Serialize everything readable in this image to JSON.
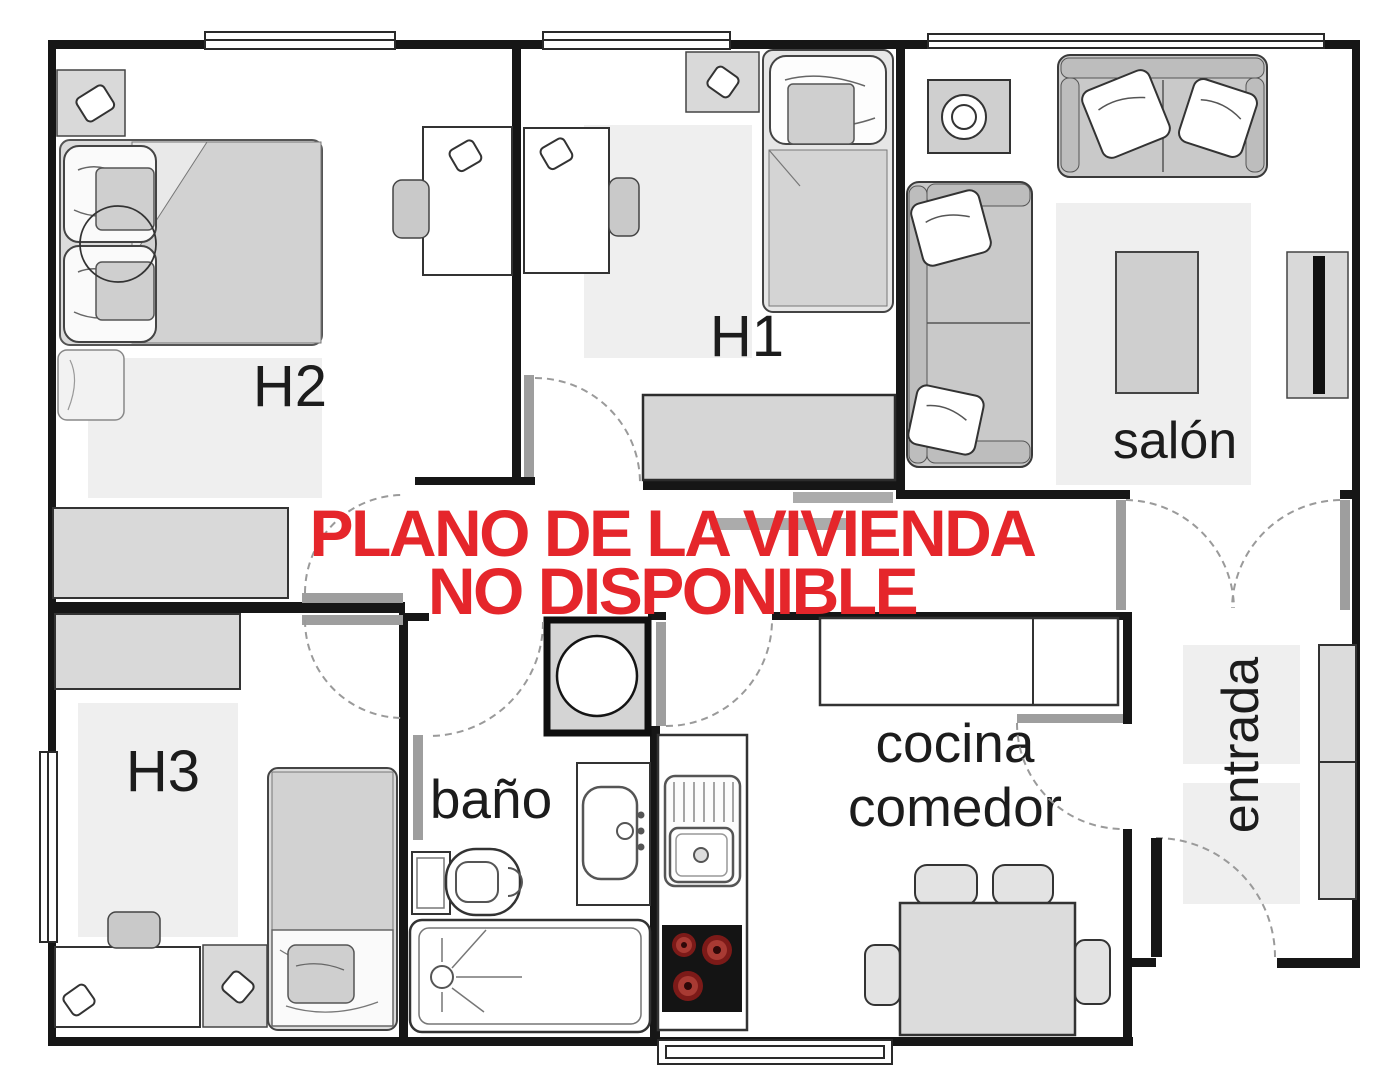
{
  "overlay": {
    "line1": "PLANO DE LA VIVIENDA",
    "line2": "NO DISPONIBLE",
    "color": "#e5262b"
  },
  "rooms": {
    "h2": {
      "label": "H2"
    },
    "h1": {
      "label": "H1"
    },
    "h3": {
      "label": "H3"
    },
    "salon": {
      "label": "salón"
    },
    "bano": {
      "label": "baño"
    },
    "cocina_comedor": {
      "line1": "cocina",
      "line2": "comedor"
    },
    "entrada": {
      "label": "entrada"
    }
  },
  "palette": {
    "wall": "#161616",
    "furniture": "#d6d6d6",
    "furniture_dark": "#c9c9c9",
    "rug": "#efefef",
    "door_leaf": "#9e9e9e",
    "window_stroke": "#2a2a2a",
    "hob_burner": "#8a201c",
    "overlay_red": "#e5262b"
  }
}
